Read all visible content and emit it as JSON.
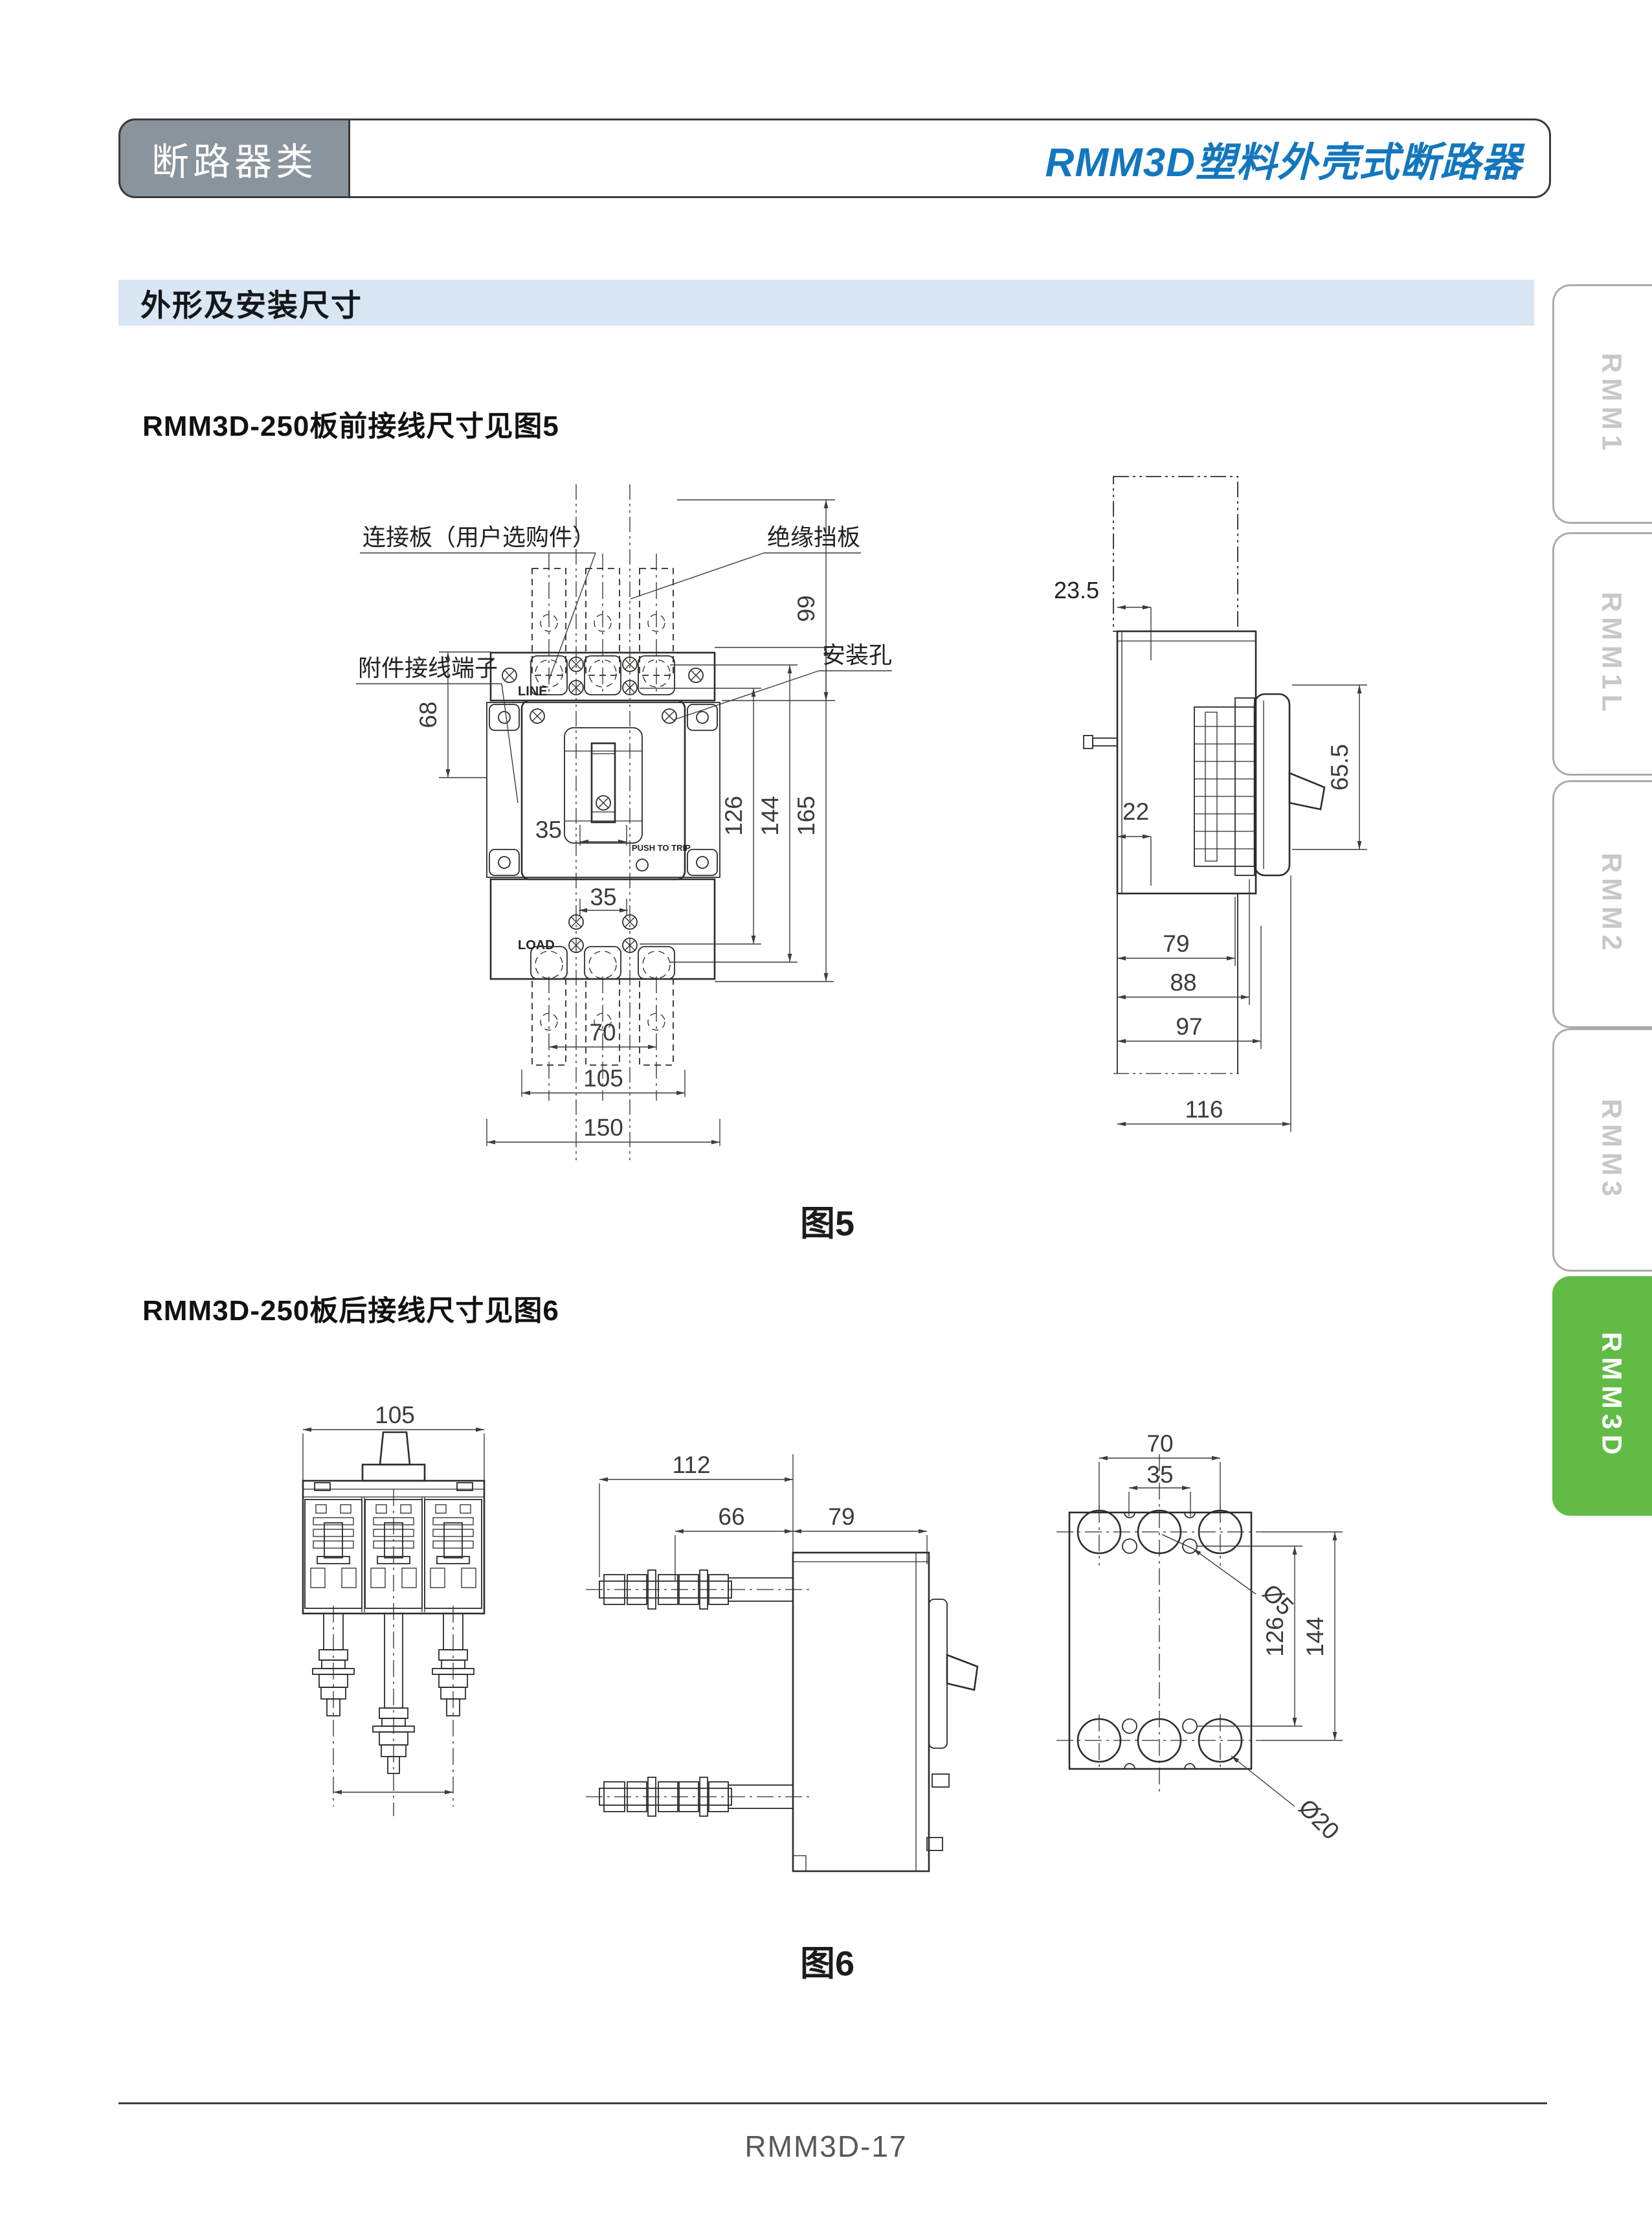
{
  "header": {
    "category": "断路器类",
    "title": "RMM3D塑料外壳式断路器"
  },
  "section": {
    "title": "外形及安装尺寸"
  },
  "fig5": {
    "heading": "RMM3D-250板前接线尺寸见图5",
    "caption": "图5",
    "callouts": {
      "connect_plate": "连接板（用户选购件）",
      "insulate_baffle": "绝缘挡板",
      "accessory_terminal": "附件接线端子",
      "mount_hole": "安装孔"
    },
    "marks": {
      "line": "LINE",
      "load": "LOAD",
      "push_to_trip": "PUSH TO TRIP"
    },
    "dims": {
      "d99": "99",
      "d68": "68",
      "d35_handle": "35",
      "d35_load": "35",
      "d126": "126",
      "d144": "144",
      "d165": "165",
      "d70": "70",
      "d105": "105",
      "d150": "150",
      "d23_5": "23.5",
      "d65_5": "65.5",
      "d22": "22",
      "d79": "79",
      "d88": "88",
      "d97": "97",
      "d116": "116"
    }
  },
  "fig6": {
    "heading": "RMM3D-250板后接线尺寸见图6",
    "caption": "图6",
    "dims": {
      "d105": "105",
      "d112": "112",
      "d66": "66",
      "d79": "79",
      "d70": "70",
      "d35": "35",
      "dia5": "Ø5",
      "d126": "126",
      "d144": "144",
      "dia20": "Ø20"
    }
  },
  "sidebar": {
    "tabs": [
      {
        "label": "RMM1",
        "active": false
      },
      {
        "label": "RMM1L",
        "active": false
      },
      {
        "label": "RMM2",
        "active": false
      },
      {
        "label": "RMM3",
        "active": false
      },
      {
        "label": "RMM3D",
        "active": true
      }
    ]
  },
  "footer": {
    "page": "RMM3D-17"
  },
  "colors": {
    "accent_blue": "#1377be",
    "section_bg": "#d9e6f4",
    "category_gray": "#8a949c",
    "tab_green": "#61bb45",
    "tab_text_gray": "#c6c8ca",
    "footer_text": "#58595b",
    "line_color": "#2e2b28"
  }
}
